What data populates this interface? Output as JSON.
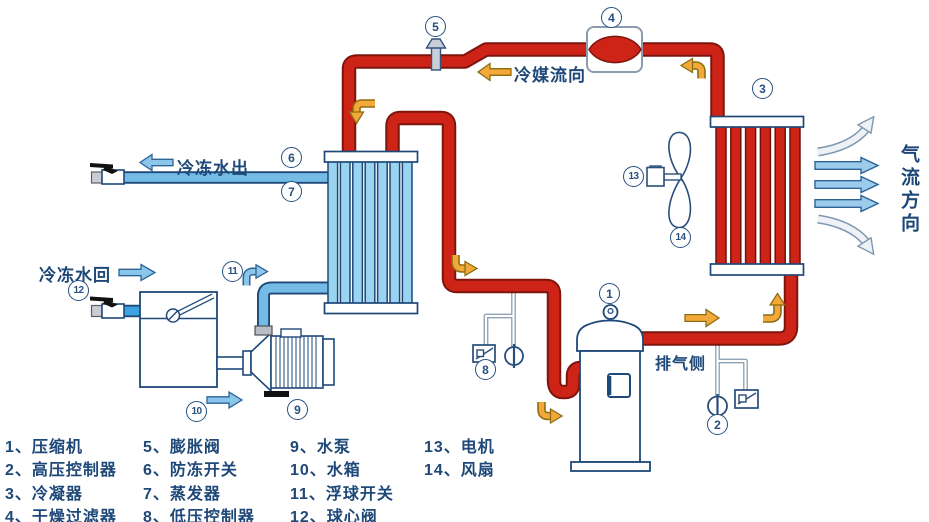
{
  "labels": {
    "refrigerant_flow": "冷媒流向",
    "chilled_water_out": "冷冻水出",
    "chilled_water_return": "冷冻水回",
    "exhaust_side": "排气侧",
    "airflow_direction": "气流方向"
  },
  "badges": [
    "1",
    "2",
    "3",
    "4",
    "5",
    "6",
    "7",
    "8",
    "9",
    "10",
    "11",
    "12",
    "13",
    "14"
  ],
  "legend": {
    "col1": [
      "1、压缩机",
      "2、高压控制器",
      "3、冷凝器",
      "4、干燥过滤器"
    ],
    "col2": [
      "5、膨胀阀",
      "6、防冻开关",
      "7、蒸发器",
      "8、低压控制器"
    ],
    "col3": [
      "9、水泵",
      "10、水箱",
      "11、浮球开关",
      "12、球心阀"
    ],
    "col4": [
      "13、电机",
      "14、风扇"
    ]
  },
  "colors": {
    "pipe_red": "#ce2418",
    "pipe_red_border": "#7d150d",
    "water_blue": "#74bce6",
    "evaporator_tube_blue": "#9bd4f1",
    "outline_navy": "#1e4878",
    "arrow_orange": "#f3a93a",
    "arrow_orange_border": "#8d6d12",
    "arrow_blue": "#8ac6ec",
    "airflow_arrow_light": "#eef2f6"
  }
}
